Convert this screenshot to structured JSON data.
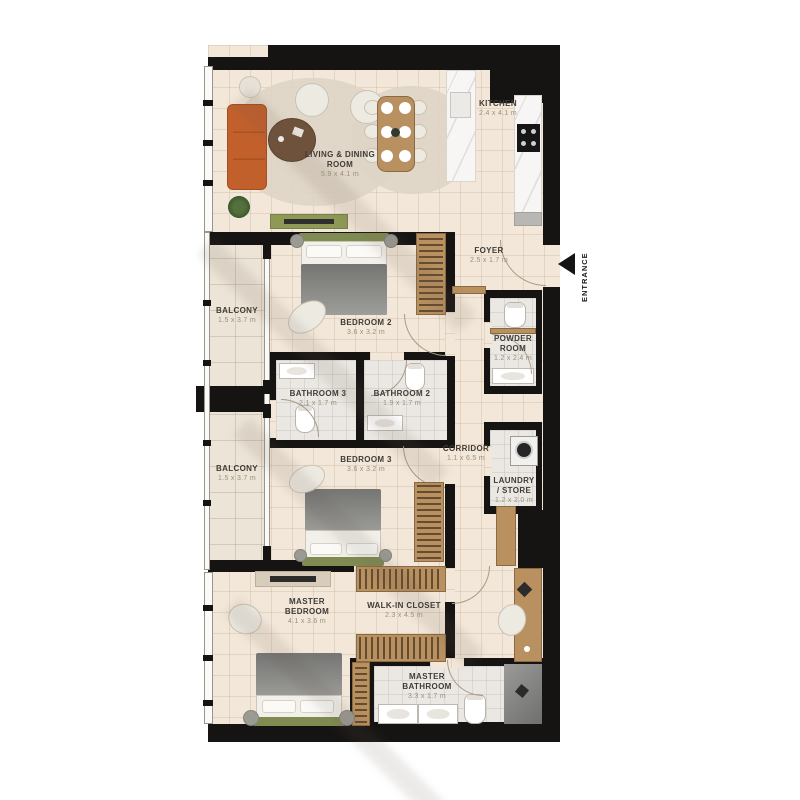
{
  "plan": {
    "entrance_label": "ENTRANCE",
    "rooms": [
      {
        "name": "LIVING & DINING ROOM",
        "dims": "5.9 x 4.1 m"
      },
      {
        "name": "KITCHEN",
        "dims": "2.4 x 4.1 m"
      },
      {
        "name": "FOYER",
        "dims": "2.5 x 1.7 m"
      },
      {
        "name": "BALCONY",
        "dims": "1.5 x 3.7 m"
      },
      {
        "name": "BEDROOM 2",
        "dims": "3.6 x 3.2 m"
      },
      {
        "name": "POWDER ROOM",
        "dims": "1.2 x 2.4 m"
      },
      {
        "name": "BATHROOM 3",
        "dims": "2.1 x 1.7 m"
      },
      {
        "name": "BATHROOM 2",
        "dims": "1.9 x 1.7 m"
      },
      {
        "name": "BALCONY",
        "dims": "1.5 x 3.7 m"
      },
      {
        "name": "BEDROOM 3",
        "dims": "3.6 x 3.2 m"
      },
      {
        "name": "CORRIDOR",
        "dims": "1.1 x 6.5 m"
      },
      {
        "name": "LAUNDRY / STORE",
        "dims": "1.2 x 2.0 m"
      },
      {
        "name": "MASTER BEDROOM",
        "dims": "4.1 x 3.6 m"
      },
      {
        "name": "WALK-IN CLOSET",
        "dims": "2.3 x 4.5 m"
      },
      {
        "name": "MASTER BATHROOM",
        "dims": "3.3 x 1.7 m"
      }
    ],
    "colors": {
      "wall": "#161412",
      "floor": "#f2e7d9",
      "balcony_floor": "#ece4d6",
      "wood": "#b9905f",
      "sofa": "#c2602c",
      "bed_frame_olive": "#7f8b51",
      "label_text": "#3f3b35",
      "dims_text": "#99907e"
    }
  }
}
